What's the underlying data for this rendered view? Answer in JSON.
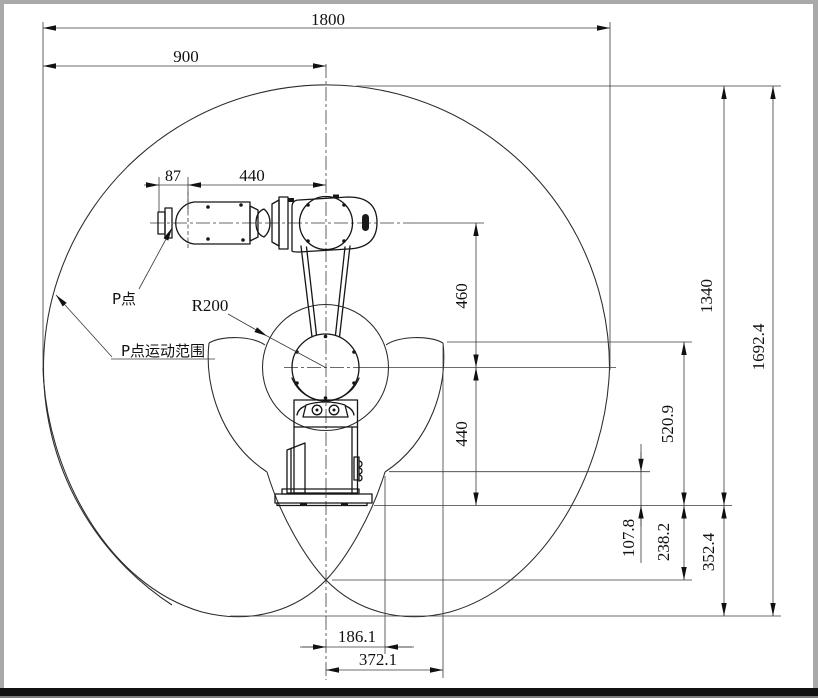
{
  "dims": {
    "total_width": "1800",
    "half_width": "900",
    "wrist_offset": "87",
    "forearm_length": "440",
    "upper_arm_length": "460",
    "shoulder_height": "440",
    "upper_reach": "1340",
    "envelope_height": "1692.4",
    "side_drop": "520.9",
    "notch_depth": "107.8",
    "below_base_depth": "238.2",
    "bottom_drop": "352.4",
    "notch_offset": "186.1",
    "corner_offset": "372.1"
  },
  "labels": {
    "radius": "R200",
    "p_point": "P点",
    "p_range": "P点运动范围"
  }
}
